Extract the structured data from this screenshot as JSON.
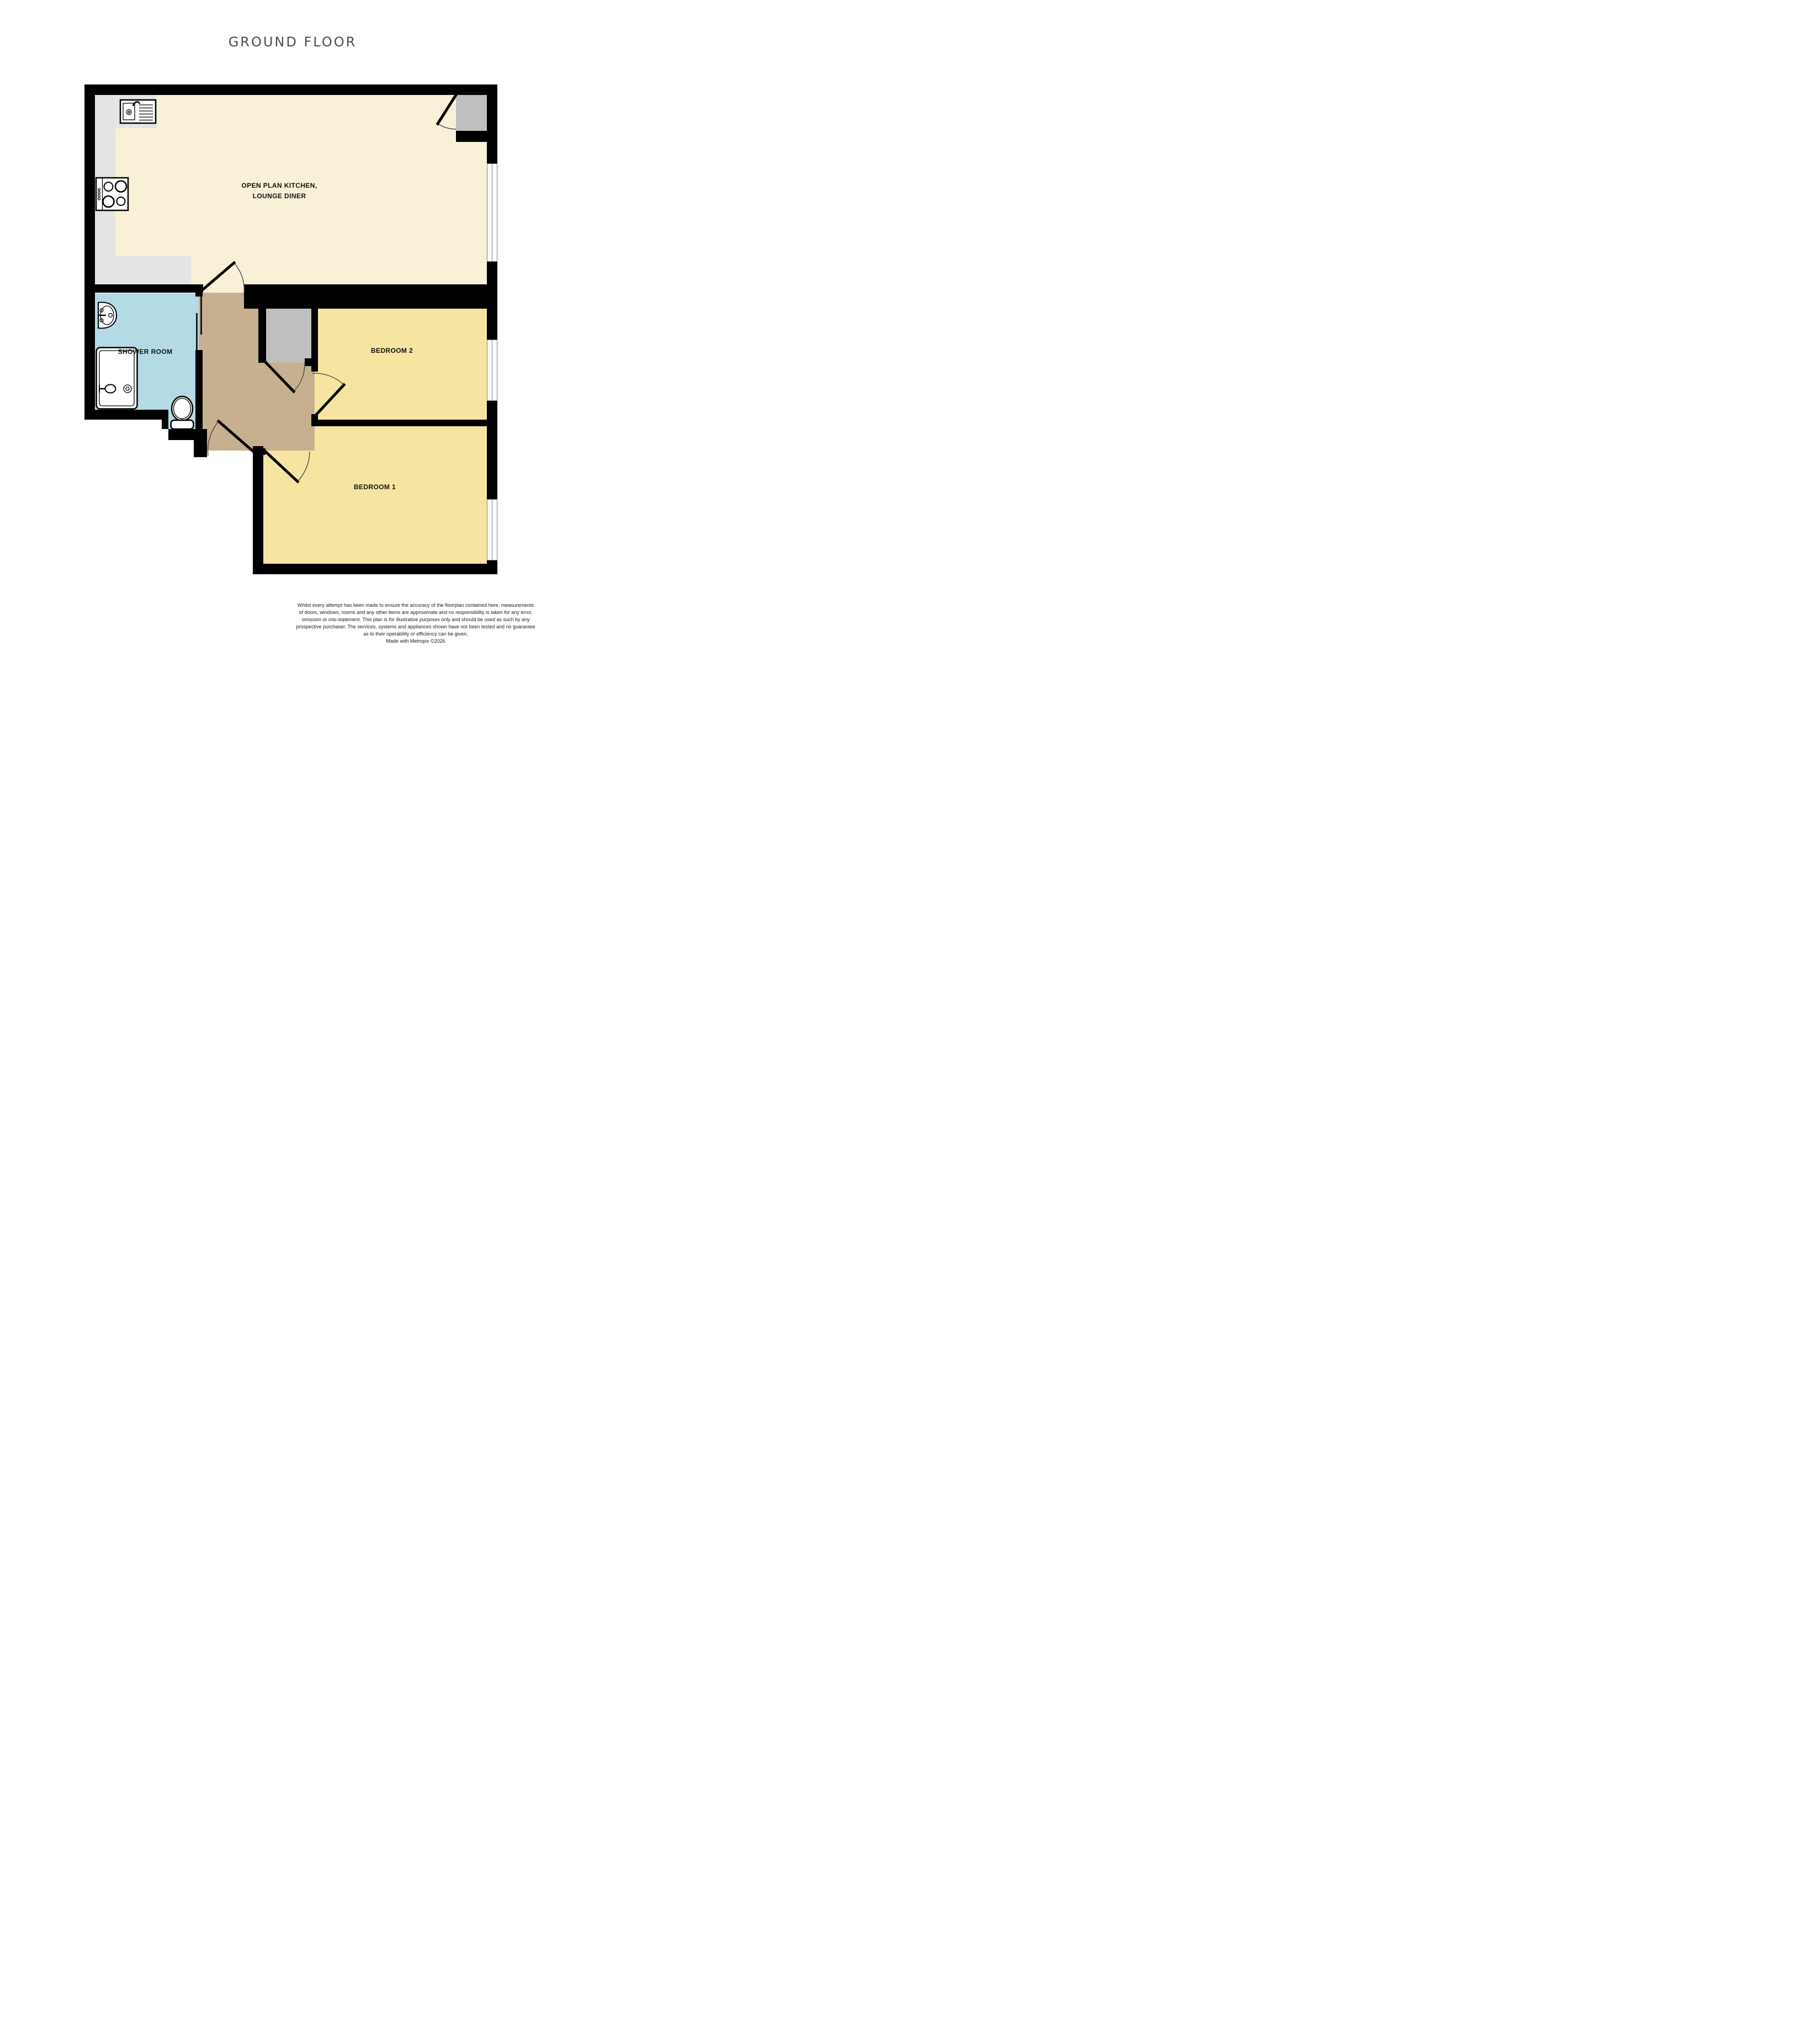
{
  "title": "GROUND FLOOR",
  "rooms": {
    "kitchen": {
      "label_lines": [
        "OPEN PLAN KITCHEN,",
        "LOUNGE DINER"
      ]
    },
    "shower_room": {
      "label": "SHOWER ROOM"
    },
    "bedroom_2": {
      "label": "BEDROOM 2"
    },
    "bedroom_1": {
      "label": "BEDROOM 1"
    }
  },
  "icons": [
    "kitchen-sink-icon",
    "hob-icon",
    "bathroom-basin-icon",
    "shower-icon",
    "toilet-icon",
    "door-arc",
    "sliding-door"
  ],
  "colors": {
    "cream": "#f8f1d8",
    "yellow": "#f5e5a0",
    "tan": "#c7b090",
    "blue": "#b4dbe4",
    "counter": "#e4e4e4",
    "cupboard": "#bfbfbf",
    "wall": "#000000",
    "title-color": "#4c4c4c",
    "arc": "#4a4a4a",
    "window-line": "#7f7f7f"
  },
  "disclaimer": {
    "lines": [
      "Whilst every attempt has been made to ensure the accuracy of the floorplan contained here, measurements",
      "of doors, windows, rooms and any other items are approximate and no responsibility is taken for any error,",
      "omission or mis-statement. This plan is for illustrative purposes only and should be used as such by any",
      "prospective purchaser. The services, systems and appliances shown have not been tested and no guarantee",
      "as to their operability or efficiency can be given.",
      "Made with Metropix ©2026"
    ]
  }
}
